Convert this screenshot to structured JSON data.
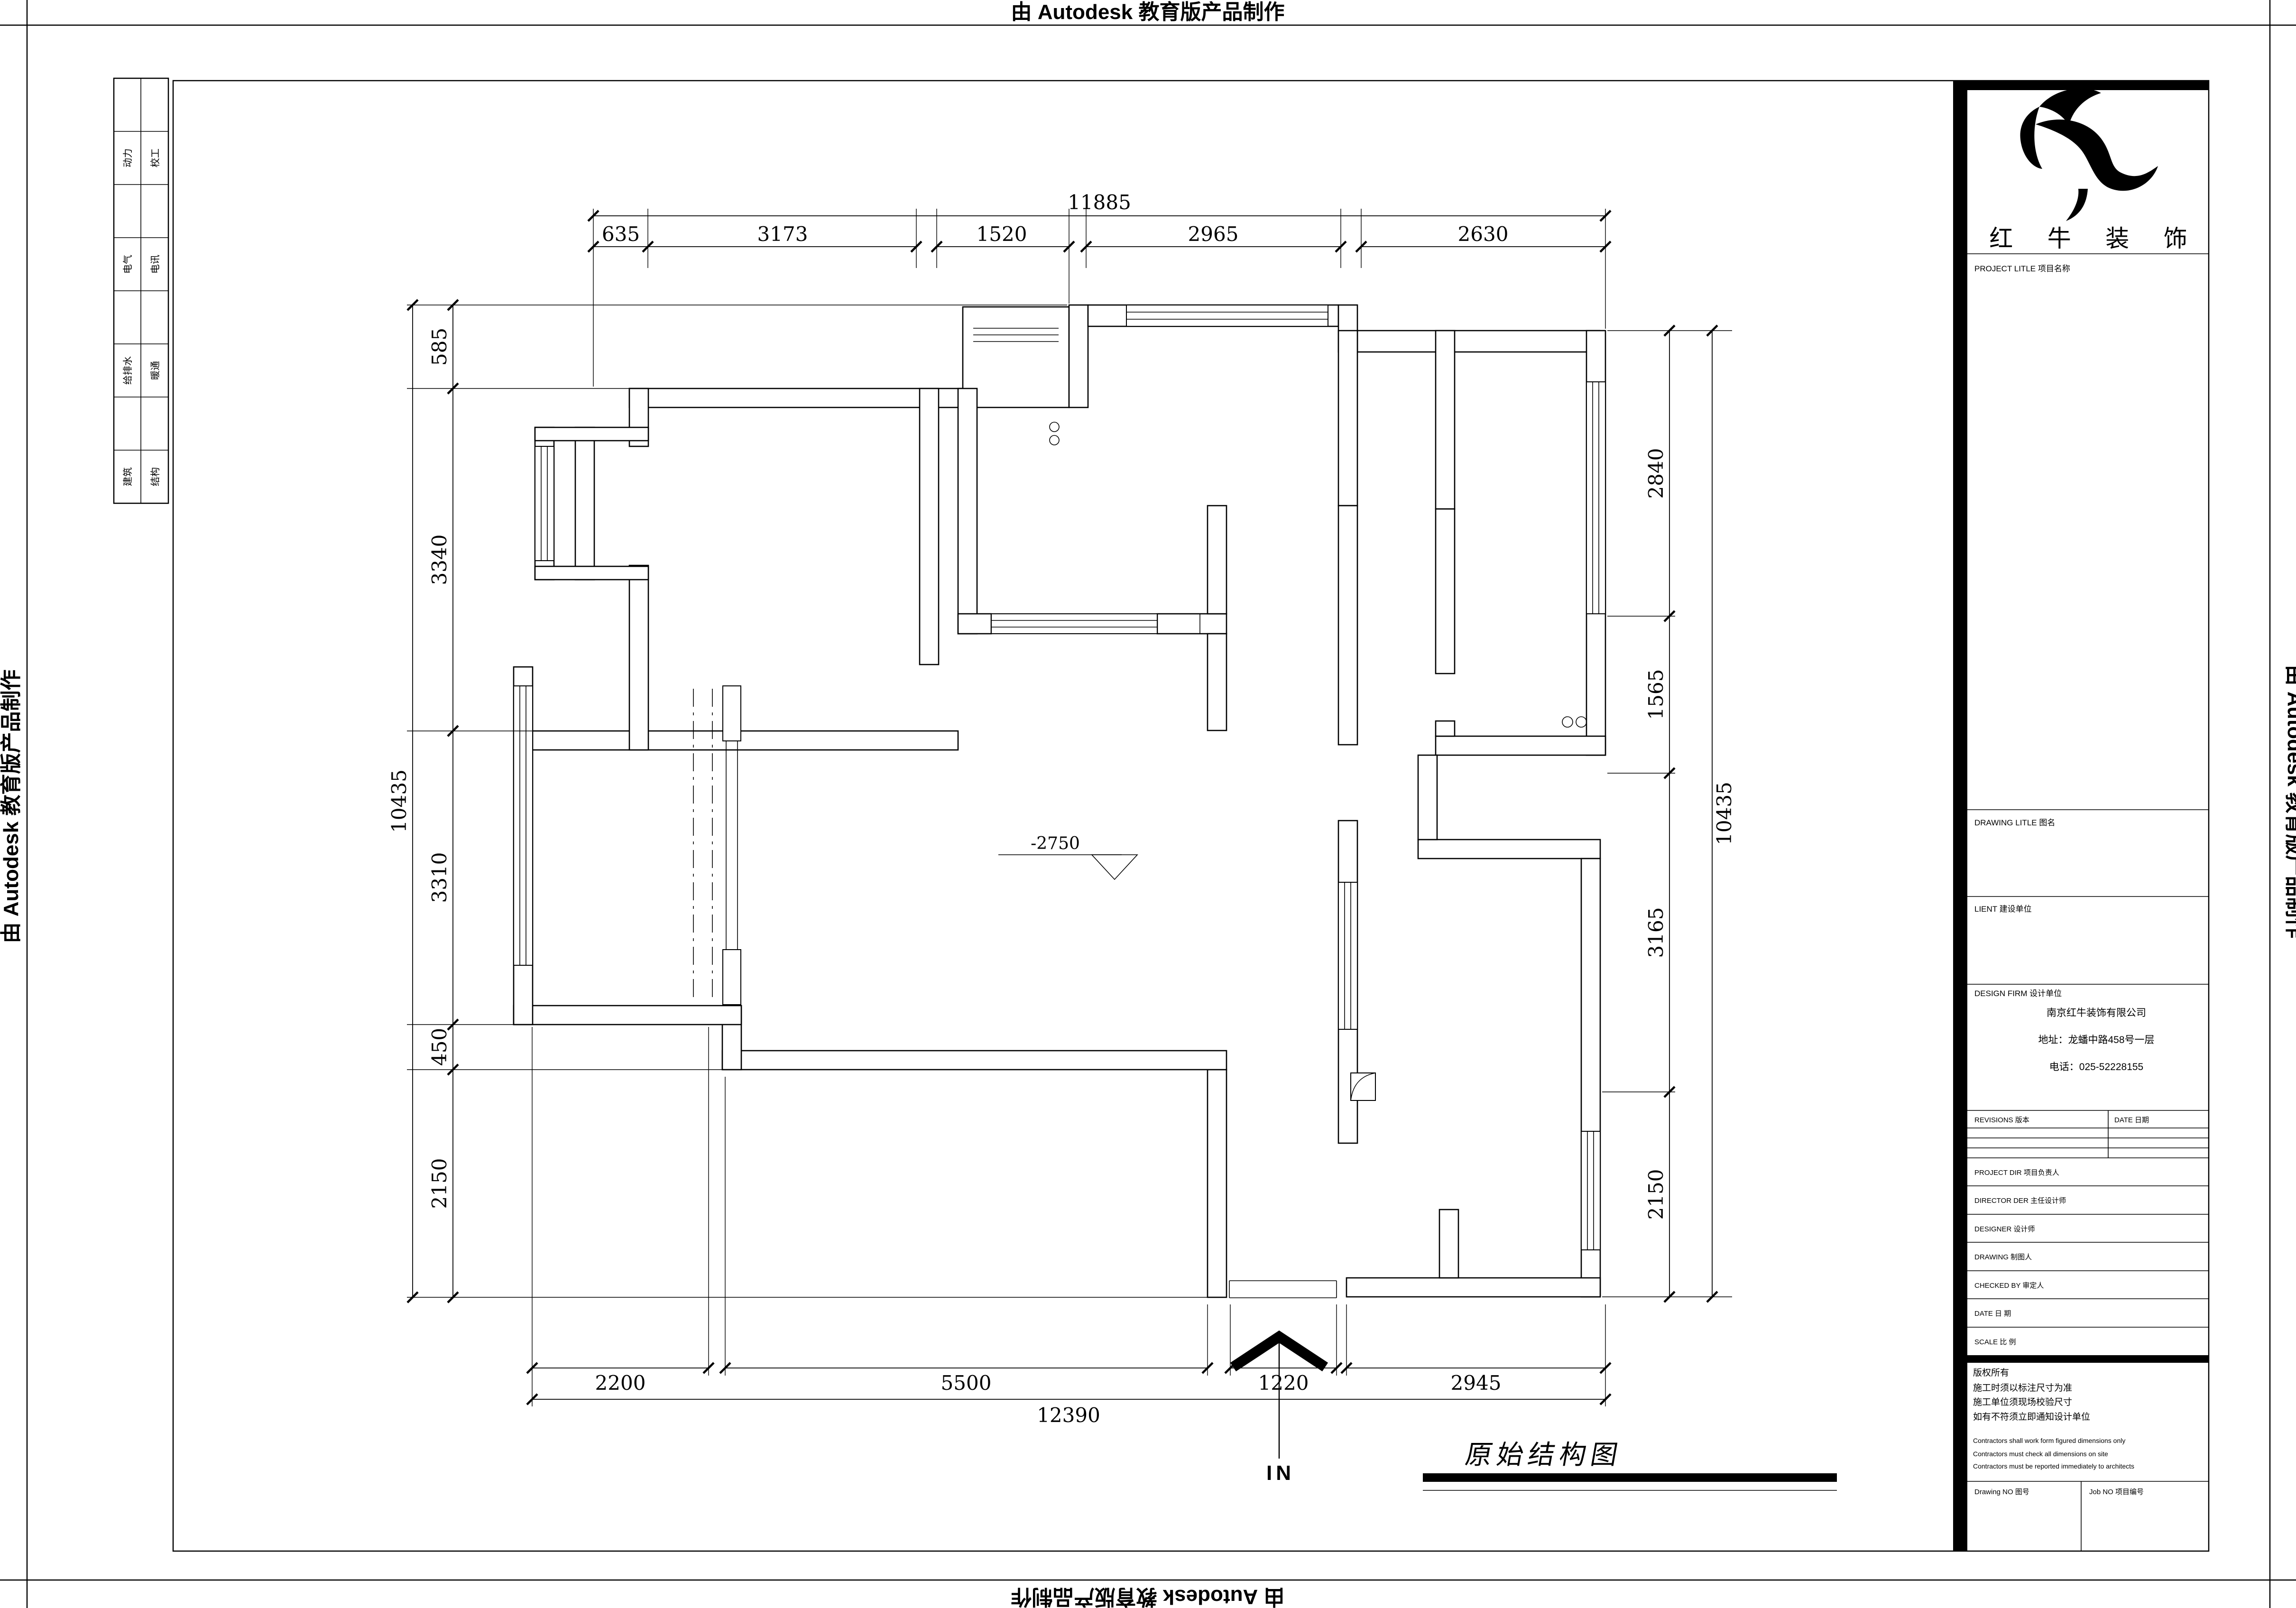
{
  "page": {
    "watermark": "由 Autodesk 教育版产品制作"
  },
  "discipline_table": {
    "left_column": [
      "动力",
      "电气",
      "给排水",
      "建筑"
    ],
    "right_column": [
      "校工",
      "电讯",
      "暖通",
      "结构"
    ]
  },
  "title_block": {
    "brand_name": "红 牛 装 饰",
    "project_title_label": "PROJECT LITLE  项目名称",
    "drawing_title_label": "DRAWING LITLE  图名",
    "client_label": "LIENT  建设单位",
    "design_firm_label": "DESIGN FIRM  设计单位",
    "company_name": "南京红牛装饰有限公司",
    "company_address": "地址：龙蟠中路458号一层",
    "company_phone": "电话：025-52228155",
    "revisions_label": "REVISIONS  版本",
    "revision_date_label": "DATE  日期",
    "project_dir_label": "PROJECT DIR  项目负责人",
    "director_label": "DIRECTOR DER  主任设计师",
    "designer_label": "DESIGNER  设计师",
    "drawing_by_label": "DRAWING  制图人",
    "checked_by_label": "CHECKED BY  审定人",
    "date_label": "DATE  日  期",
    "scale_label": "SCALE  比  例",
    "copyright_note": "版权所有",
    "note_cn_1": "施工时须以标注尺寸为准",
    "note_cn_2": "施工单位须现场校验尺寸",
    "note_cn_3": "如有不符须立即通知设计单位",
    "note_en_1": "Contractors shall work form figured dimensions only",
    "note_en_2": "Contractors must check all dimensions on site",
    "note_en_3": "Contractors must be reported immediately to architects",
    "drawing_no_label": "Drawing NO  图号",
    "job_no_label": "Job NO  项目编号"
  },
  "plan": {
    "drawing_label": "原始结构图",
    "level_marker": "-2750",
    "entrance_label": "IN"
  },
  "dims": {
    "top": {
      "overall": "11885",
      "segments": [
        "635",
        "3173",
        "1520",
        "2965",
        "2630"
      ]
    },
    "left": {
      "overall": "10435",
      "segments": [
        "585",
        "3340",
        "3310",
        "450",
        "2150"
      ]
    },
    "right": {
      "overall": "10435",
      "segments": [
        "2840",
        "1565",
        "3165",
        "2150"
      ]
    },
    "bottom": {
      "overall": "12390",
      "segments": [
        "2200",
        "5500",
        "1220",
        "2945"
      ]
    }
  }
}
